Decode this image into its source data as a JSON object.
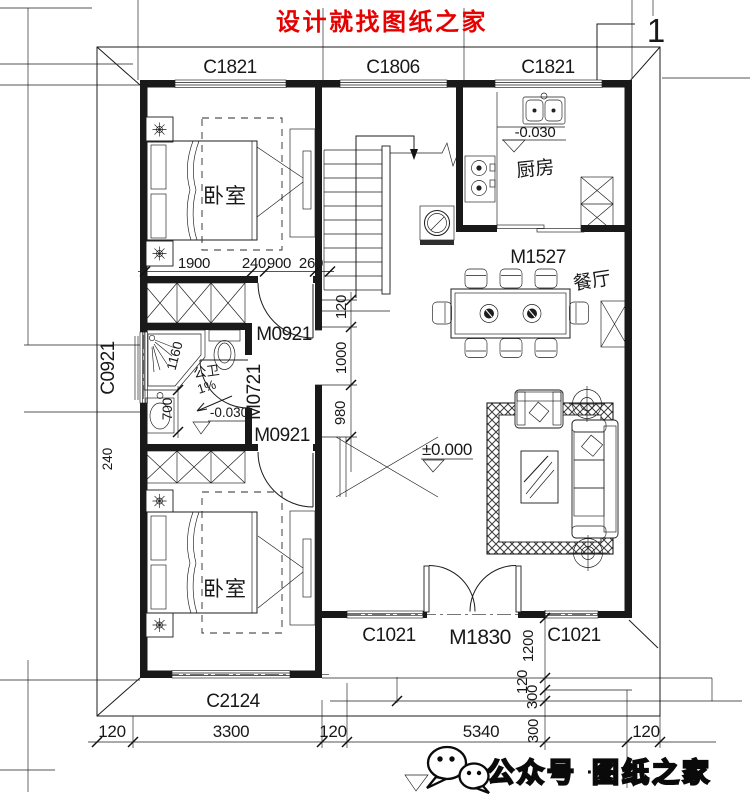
{
  "header": {
    "title": "设计就找图纸之家",
    "sheet_no": "1"
  },
  "windows": {
    "top_left": "C1821",
    "top_mid": "C1806",
    "top_right": "C1821",
    "left_bath": "C0921",
    "bottom_bedroom": "C2124",
    "porch_left": "C1021",
    "porch_right": "C1021"
  },
  "doors": {
    "bedroom1": "M0921",
    "bedroom2": "M0921",
    "bathroom": "M0721",
    "kitchen": "M1527",
    "entry": "M1830"
  },
  "rooms": {
    "bedroom1": "卧室",
    "bedroom2": "卧室",
    "kitchen": "厨房",
    "dining": "餐厅",
    "bath": "公卫"
  },
  "levels": {
    "kitchen": "-0.030",
    "bath": "-0.030",
    "living": "±0.000",
    "slope": "1%"
  },
  "dims": {
    "bed_row": [
      "1900",
      "240",
      "900",
      "260"
    ],
    "mid_col": [
      "120",
      "1000",
      "980"
    ],
    "bath": [
      "1160",
      "700",
      "240"
    ],
    "right_col": [
      "1200",
      "120",
      "300",
      "300"
    ],
    "bottom_row": [
      "120",
      "3300",
      "120",
      "5340",
      "120"
    ]
  },
  "footer": {
    "account": "公众号",
    "dot": "·",
    "brand": "图纸之家"
  },
  "icons": {
    "footer_logo": "wechat-icon"
  },
  "colors": {
    "title_red": "#e60000",
    "line": "#1c1c1c"
  }
}
